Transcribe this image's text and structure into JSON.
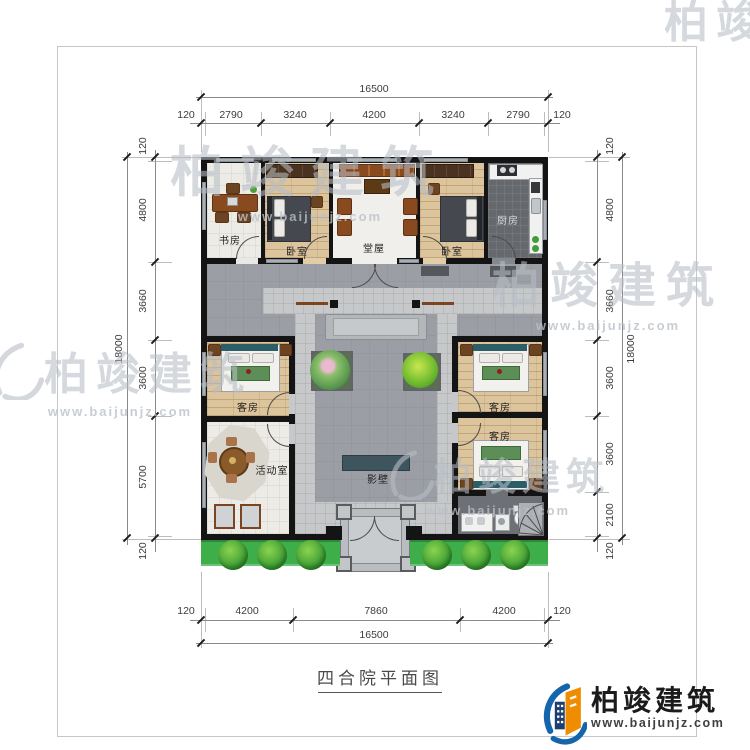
{
  "document": {
    "title": "四合院平面图"
  },
  "brand": {
    "name": "柏竣建筑",
    "url": "www.baijunjz.com"
  },
  "watermark": {
    "name": "柏竣建筑",
    "url": "www.baijunjz.com"
  },
  "dims": {
    "top": {
      "total": "16500",
      "segments": [
        "120",
        "2790",
        "3240",
        "4200",
        "3240",
        "2790",
        "120"
      ]
    },
    "bottom": {
      "total": "16500",
      "segments": [
        "120",
        "4200",
        "7860",
        "4200",
        "120"
      ]
    },
    "left": {
      "total": "18000",
      "segments": [
        "120",
        "4800",
        "3660",
        "3600",
        "5700",
        "120"
      ]
    },
    "right": {
      "total": "18000",
      "segments": [
        "120",
        "4800",
        "3660",
        "3600",
        "3600",
        "2100",
        "120"
      ]
    }
  },
  "rooms": {
    "study": "书房",
    "bedroom_left": "卧室",
    "hall": "堂屋",
    "bedroom_right": "卧室",
    "kitchen": "厨房",
    "guest_west": "客房",
    "activity": "活动室",
    "guest_east_upper": "客房",
    "guest_east_lower": "客房",
    "screen_wall": "影壁"
  },
  "palette": {
    "wall": "#141414",
    "courtyard": "#9b9ea4",
    "wood_floor": "#dcc49c",
    "tile_floor": "#ecebe6",
    "kitchen_floor": "#65696e",
    "greenery": "#3eae4b",
    "screen_wall": "#3f555d",
    "brand_blue": "#1565ad",
    "brand_orange": "#f08c00"
  }
}
